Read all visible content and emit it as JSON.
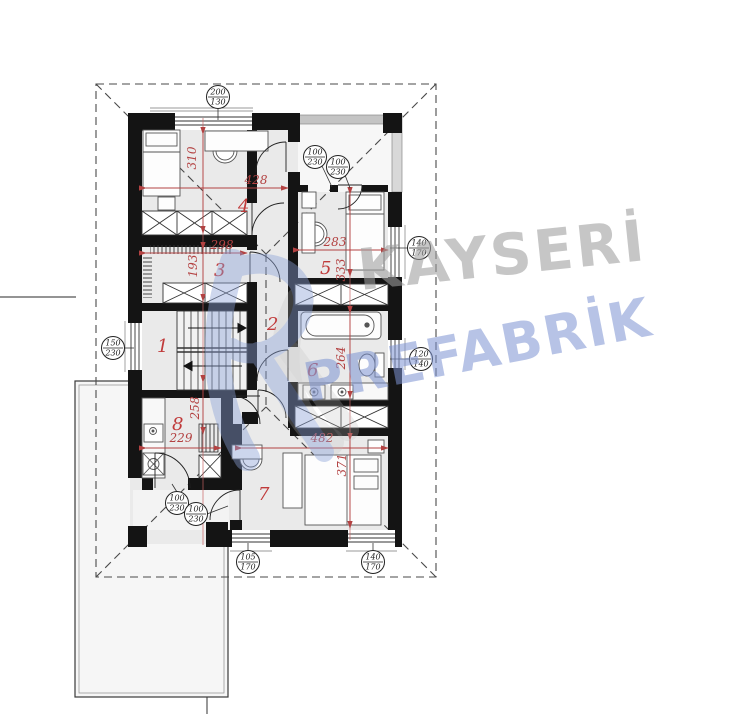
{
  "watermark": {
    "word1": "KAYSERİ",
    "word2": "PREFABRİK"
  },
  "rooms": {
    "r1": "1",
    "r2": "2",
    "r3": "3",
    "r4": "4",
    "r5": "5",
    "r6": "6",
    "r7": "7",
    "r8": "8"
  },
  "dimensions": {
    "d310": "310",
    "d428": "428",
    "d298": "298",
    "d193": "193",
    "d283": "283",
    "d333": "333",
    "d264": "264",
    "d258": "258",
    "d229": "229",
    "d482": "482",
    "d371": "371"
  },
  "opening_tags": [
    {
      "top": "200",
      "bottom": "130"
    },
    {
      "top": "100",
      "bottom": "230"
    },
    {
      "top": "100",
      "bottom": "230"
    },
    {
      "top": "140",
      "bottom": "170"
    },
    {
      "top": "120",
      "bottom": "140"
    },
    {
      "top": "150",
      "bottom": "230"
    },
    {
      "top": "100",
      "bottom": "230"
    },
    {
      "top": "100",
      "bottom": "230"
    },
    {
      "top": "105",
      "bottom": "170"
    },
    {
      "top": "140",
      "bottom": "170"
    }
  ],
  "colors": {
    "dimension_red": "#b34242",
    "wall_black": "#141414",
    "floor_gray": "#eaeaea",
    "watermark_gray": "#9e9e9e",
    "watermark_blue": "#7d93d2"
  }
}
